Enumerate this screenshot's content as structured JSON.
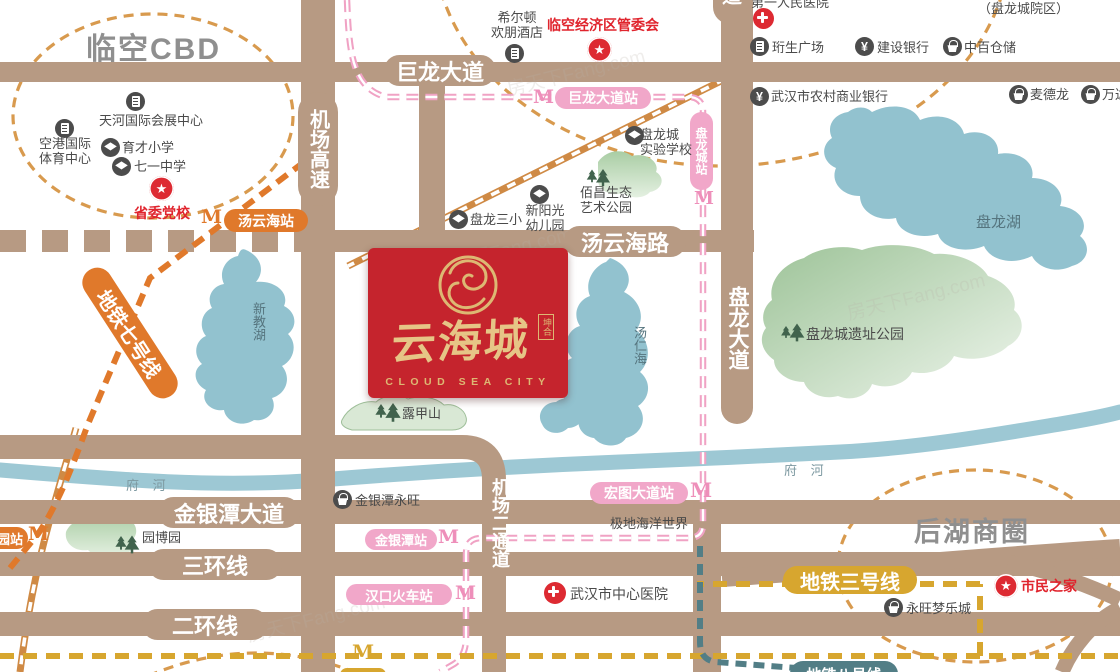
{
  "watermark": {
    "text": "房天下Fang.com"
  },
  "areas": {
    "linkong_cbd": "临空CBD",
    "houhu": "后湖商圈"
  },
  "waters": {
    "xinjiaohu": "新教湖",
    "tangrenhai": "汤仁海",
    "panlonghu": "盘龙湖",
    "fuhe": "府 河"
  },
  "roads": {
    "julong": "巨龙大道",
    "jichang_gaosu": "机场高速",
    "tangyunhai": "汤云海路",
    "panlong_dadao": "盘龙大道",
    "dao_fragment": "道",
    "jichang_ertongdao": "机场二通道",
    "jinyintan_dadao": "金银潭大道",
    "sanhuan": "三环线",
    "erhuan": "二环线"
  },
  "metro": {
    "m": "M",
    "line2_color": "#f0a2c4",
    "line3_color": "#d7a62f",
    "line7_color": "#e0792b",
    "line8_color": "#527e86",
    "line3_label": "地铁三号线",
    "line7_label": "地铁七号线",
    "line8_label": "地铁八号线",
    "stations": {
      "julong": "巨龙大道站",
      "panlongcheng": "盘龙城站",
      "tangyunhai": "汤云海站",
      "hongtu": "宏图大道站",
      "jinyintan": "金银潭站",
      "hankou": "汉口火车站",
      "yuanbo_fragment": "园站"
    }
  },
  "pois": {
    "tianhe_expo": {
      "label": "天河国际会展中心"
    },
    "konggang_sports": {
      "line1": "空港国际",
      "line2": "体育中心"
    },
    "yucai": {
      "label": "育才小学"
    },
    "qiyi": {
      "label": "七一中学"
    },
    "shengwei": {
      "label": "省委党校"
    },
    "hilton": {
      "line1": "希尔顿",
      "line2": "欢朋酒店"
    },
    "linkong_mgmt": {
      "label": "临空经济区管委会"
    },
    "plc_school": {
      "line1": "盘龙城",
      "line2": "实验学校"
    },
    "baichang": {
      "line1": "佰昌生态",
      "line2": "艺术公园"
    },
    "xinyangguang": {
      "line1": "新阳光",
      "line2": "幼儿园"
    },
    "panlong_sanxiao": {
      "label": "盘龙三小"
    },
    "diyi_hospital": {
      "label": "第一人民医院"
    },
    "plc_campus": {
      "label": "（盘龙城院区）"
    },
    "hengsheng": {
      "label": "珩生广场"
    },
    "ccb": {
      "label": "建设银行"
    },
    "zhongbai": {
      "label": "中百仓储"
    },
    "rural_bank": {
      "label": "武汉市农村商业银行"
    },
    "maidelong": {
      "label": "麦德龙"
    },
    "wanda": {
      "label": "万达"
    },
    "ruins_park": {
      "label": "盘龙城遗址公园"
    },
    "lujiashan": {
      "label": "露甲山"
    },
    "yuanboyuan": {
      "label": "园博园"
    },
    "jyt_aeon": {
      "label": "金银潭永旺"
    },
    "polar_ocean": {
      "label": "极地海洋世界"
    },
    "center_hospital": {
      "label": "武汉市中心医院"
    },
    "aeon_dream": {
      "label": "永旺梦乐城"
    },
    "citizens_home": {
      "label": "市民之家"
    }
  },
  "logo": {
    "name_cn": "云海城",
    "name_en": "CLOUD SEA CITY",
    "seal": "坤合",
    "bg_color": "#c5242d",
    "gold_color": "#e2c183"
  }
}
